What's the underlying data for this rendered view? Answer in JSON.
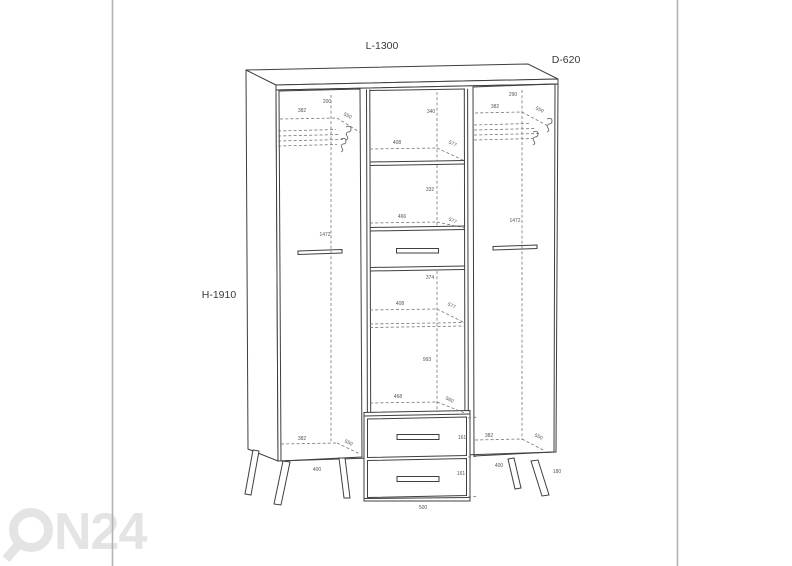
{
  "frame": {
    "border_color": "#b3b3b3"
  },
  "title_dimensions": {
    "length": "L-1300",
    "depth": "D-620",
    "height": "H-1910"
  },
  "left_section": {
    "top_clearance": "200",
    "rail_width": "382",
    "rail_depth": "550",
    "door_height": "1472",
    "bottom_width": "382",
    "bottom_depth": "550",
    "leg_spacing": "400"
  },
  "center_section": {
    "top_clearance": "340",
    "shelf1_width": "408",
    "shelf1_depth": "577",
    "compartment2_height": "332",
    "shelf2_width": "466",
    "shelf2_depth": "577",
    "compartment3_height": "374",
    "shelf3_width": "408",
    "shelf3_depth": "577",
    "compartment4_height": "993",
    "drawer_top_width": "468",
    "drawer_top_depth": "560",
    "drawer1_height": "161",
    "drawer2_height": "161",
    "base_width": "500"
  },
  "right_section": {
    "top_clearance": "290",
    "rail_width": "382",
    "rail_depth": "550",
    "door_height": "1472",
    "bottom_width": "382",
    "bottom_depth": "550",
    "leg_spacing": "400",
    "leg_height": "180"
  },
  "watermark": {
    "text": "N24",
    "full_text": "ON24",
    "color": "#e4e4e4"
  },
  "drawing": {
    "line_color": "#3f3f3f",
    "dashed_color": "#757575",
    "dim_text_color": "#555555"
  }
}
